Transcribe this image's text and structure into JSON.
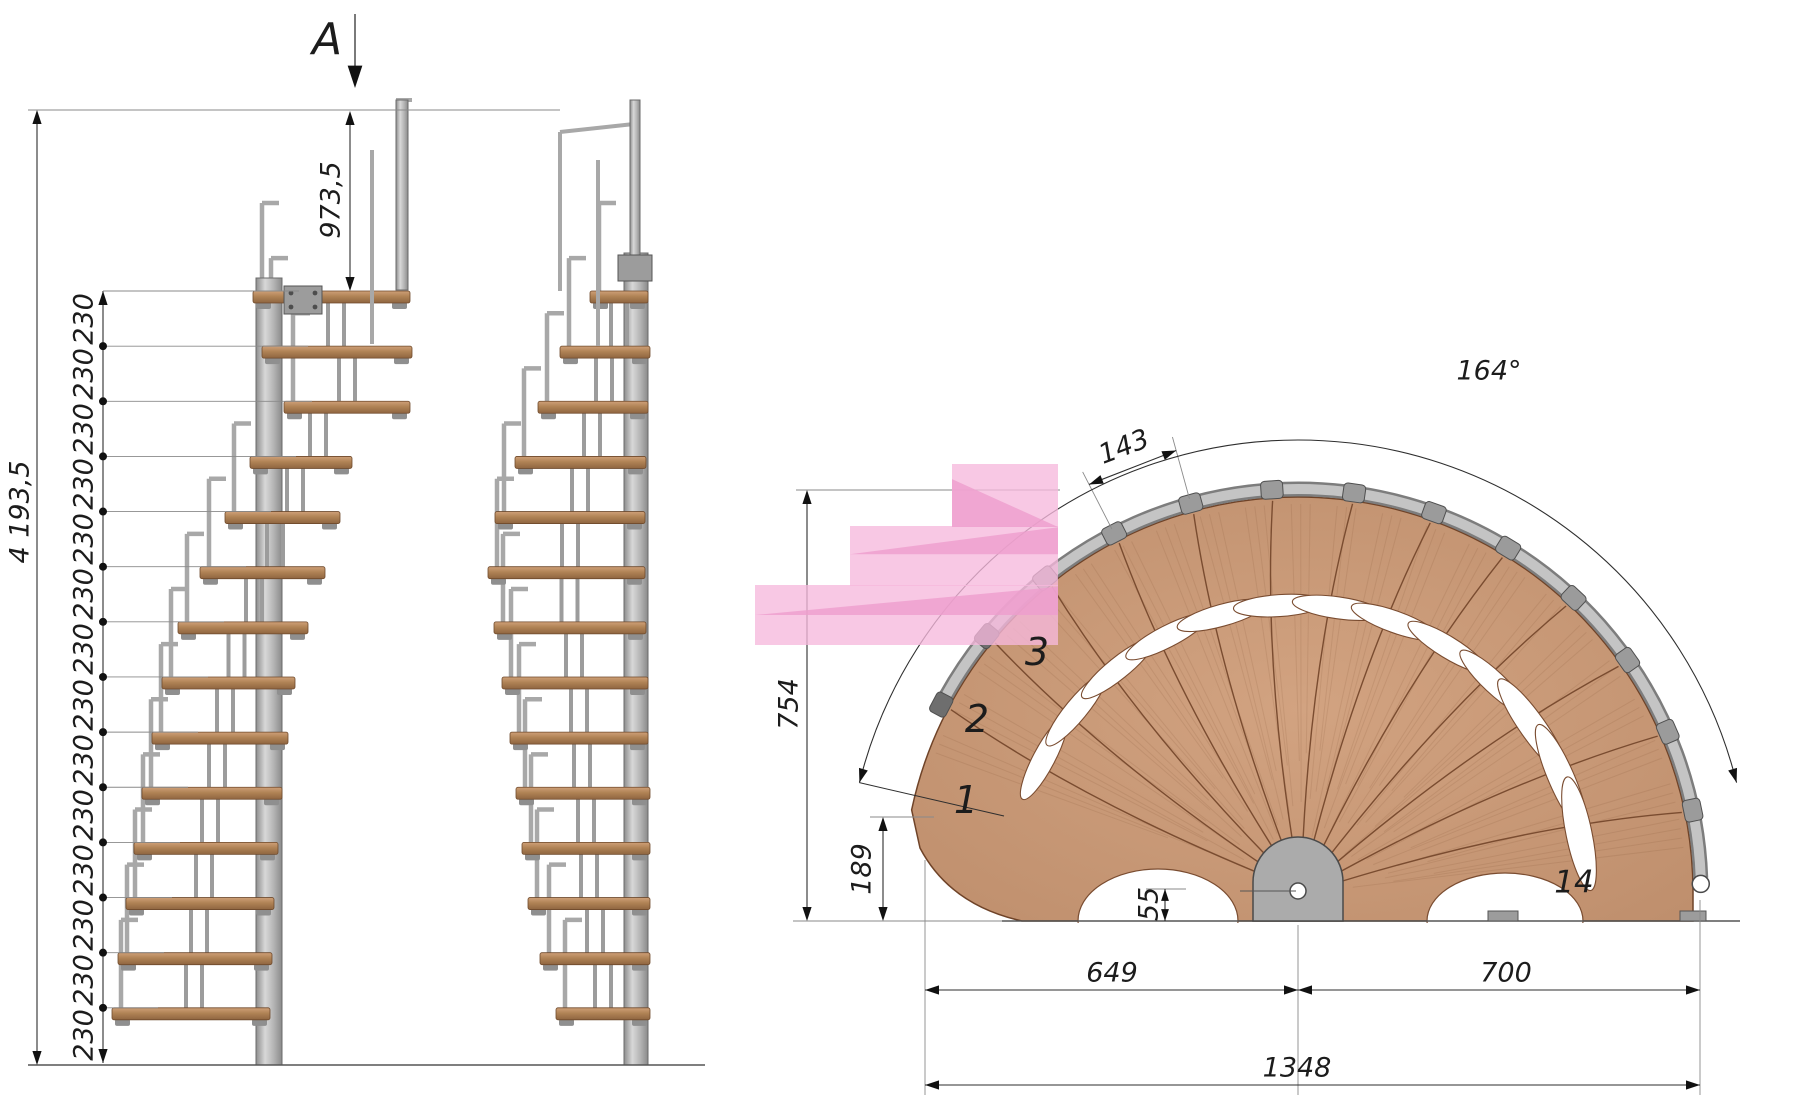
{
  "section_marker": {
    "label": "A"
  },
  "elevation_dims": {
    "overall_height": "4 193,5",
    "platform_drop": "973,5",
    "riser_labels": [
      "230",
      "230",
      "230",
      "230",
      "230",
      "230",
      "230",
      "230",
      "230",
      "230",
      "230",
      "230",
      "230",
      "230"
    ]
  },
  "plan_dims": {
    "tread_outer_width": "143",
    "fan_angle": "164°",
    "height_to_wall": "754",
    "step1_corner_offset": "189",
    "pole_base_offset": "55",
    "span_left_of_pole": "649",
    "span_right_of_pole": "700",
    "overall_span": "1348"
  },
  "plan_view": {
    "steps_total": 14,
    "step_labels": [
      "1",
      "2",
      "3",
      "14"
    ]
  },
  "colors": {
    "wood": "#c69677",
    "wood_mid": "#b9885f",
    "wood_dark": "#7a4c30",
    "steel_light": "#d6d6d6",
    "steel": "#a8a8a8",
    "steel_dark": "#5f5f5f",
    "dim": "#2e2e2e",
    "ext": "#8a8a8a",
    "pink": "#f7bddf",
    "pink_dark": "#f0a8d2"
  }
}
